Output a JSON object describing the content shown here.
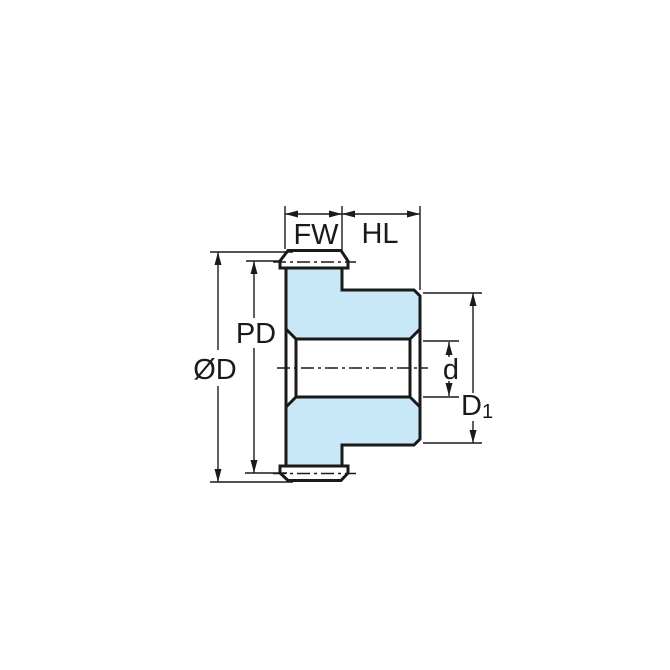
{
  "drawing": {
    "type": "spur-gear-cross-section-dimension-diagram",
    "labels": {
      "face_width": "FW",
      "hub_length": "HL",
      "pitch_diameter": "PD",
      "outside_diameter": "ØD",
      "bore_diameter": "d",
      "hub_diameter_main": "D",
      "hub_diameter_sub": "1"
    },
    "colors": {
      "line": "#1a1a1a",
      "gear_fill": "#c8e8f8",
      "background": "#ffffff"
    }
  }
}
